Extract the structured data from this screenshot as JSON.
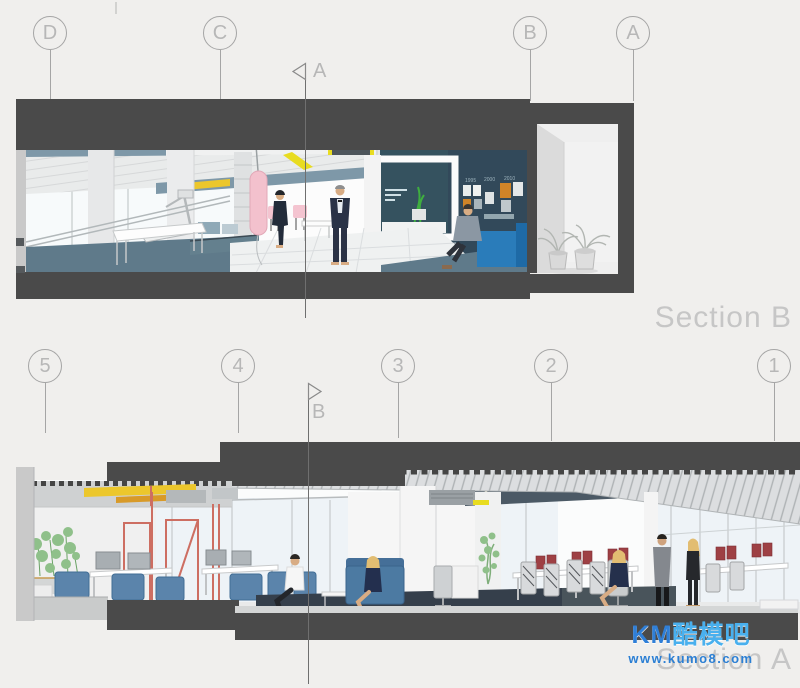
{
  "grid_top": {
    "labels": [
      "D",
      "C",
      "B",
      "A"
    ]
  },
  "grid_bottom": {
    "labels": [
      "5",
      "4",
      "3",
      "2",
      "1"
    ]
  },
  "section_cut_markers": {
    "top_label": "A",
    "bottom_label": "B"
  },
  "section_titles": {
    "upper": "Section B",
    "lower": "Section A"
  },
  "wall_timeline_years": [
    "1995",
    "2000",
    "2010"
  ],
  "watermark": {
    "brand_latin": "KM",
    "brand_cjk": "酷模吧",
    "url": "www.kumo8.com"
  },
  "colors": {
    "background": "#f0efed",
    "slab_dark": "#4a4a4a",
    "bubble_stroke": "#a5a5a5",
    "bubble_text": "#b7b7b7",
    "section_line": "#6f6f6f",
    "section_title": "#c6c6c6",
    "teal_wall": "#32495a",
    "floor_blue": "#5f7a8a",
    "glass": "#eef3f7",
    "accent_yellow": "#e8dc20",
    "duct_yellow": "#ecc72c",
    "bag_pink": "#f3c1cd",
    "chair_blue": "#5b84ab",
    "seat_blue": "#2a7cba",
    "red_frame": "#cd6e62",
    "monitor_red": "#9e4044",
    "plant_green": "#8fc08a",
    "navy_carpet": "#353f4b",
    "watermark_latin": "#2f7fd8",
    "watermark_cjk": "#49b0ee",
    "watermark_url": "#2b7fd4"
  }
}
